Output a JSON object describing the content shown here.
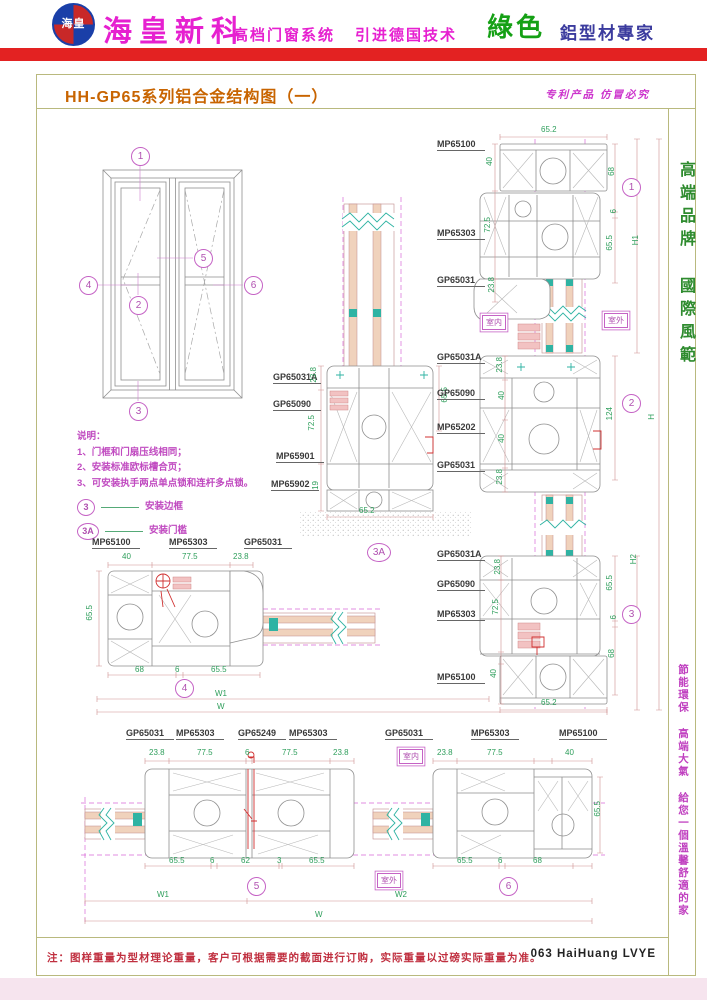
{
  "colors": {
    "brand_magenta": "#e620d0",
    "header_green": "#15a015",
    "header_blue": "#3b3b9e",
    "red_bar": "#e32222",
    "title_orange": "#c86400",
    "callout_magenta": "#c563c5",
    "dim_green": "#2e9e5b",
    "note_red": "#c03040",
    "frame_border": "#b9b97e"
  },
  "header": {
    "logo_text": "海皇",
    "brand": "海皇新科",
    "tagline1": "高档门窗系统",
    "tagline2": "引进德国技术",
    "green": "綠色",
    "expert": "鋁型材專家"
  },
  "titlebar": {
    "title": "HH-GP65系列铝合金结构图（一）",
    "patent": "专利产品 仿冒必究"
  },
  "sidebar": {
    "top": "高端品牌 國際風範",
    "bottom": "節能環保 高端大氣 給您一個溫馨舒適的家"
  },
  "footer": {
    "note": "注：图样重量为型材理论重量，客户可根据需要的截面进行订购，实际重量以过磅实际重量为准。",
    "page_code": "063 HaiHuang LVYE"
  },
  "notes": {
    "heading": "说明：",
    "lines": [
      "1、门框和门扇压线相同；",
      "2、安装标准欧标槽合页；",
      "3、可安装执手两点单点锁和连杆多点锁。"
    ],
    "legend": [
      {
        "num": "3",
        "text": "安装边框"
      },
      {
        "num": "3A",
        "text": "安装门槛"
      }
    ]
  },
  "room": {
    "inside": "室内",
    "outside": "室外"
  },
  "callouts": {
    "c1": "1",
    "c2": "2",
    "c3": "3",
    "c4": "4",
    "c5": "5",
    "c6": "6",
    "c3a": "3A"
  },
  "details": {
    "d1": {
      "profiles": [
        "MP65100",
        "MP65303",
        "GP65031"
      ],
      "dims": {
        "top": "65.2",
        "left": [
          "40",
          "72.5",
          "23.8"
        ],
        "right": [
          "68",
          "6",
          "65.5"
        ],
        "height": "H1"
      }
    },
    "d2": {
      "profiles": [
        "GP65031A",
        "GP65090",
        "MP65202",
        "GP65031"
      ],
      "dims": {
        "left": [
          "23.8",
          "40",
          "40",
          "23.8"
        ],
        "right": [
          "124"
        ],
        "height": "H"
      }
    },
    "d3": {
      "profiles": [
        "GP65031A",
        "GP65090",
        "MP65303",
        "MP65100"
      ],
      "dims": {
        "left": [
          "23.8",
          "72.5",
          "40"
        ],
        "right": [
          "65.5",
          "6",
          "68"
        ],
        "bottom": "65.2",
        "height": "H2"
      }
    },
    "d3a": {
      "profiles": [
        "GP65031A",
        "GP65090",
        "MP65901",
        "MP65902"
      ],
      "dims": {
        "left": [
          "23.8",
          "72.5",
          "19"
        ],
        "right": [
          "65.5"
        ],
        "bottom": "65.2"
      }
    },
    "d4": {
      "profiles": [
        "MP65100",
        "MP65303",
        "GP65031"
      ],
      "dims": {
        "top": [
          "40",
          "77.5",
          "23.8"
        ],
        "left": [
          "65.5"
        ],
        "bottom": [
          "68",
          "6",
          "65.5"
        ]
      }
    },
    "d5": {
      "profiles": [
        "GP65031",
        "MP65303",
        "GP65249",
        "MP65303"
      ],
      "dims": {
        "top": [
          "23.8",
          "77.5",
          "6",
          "77.5",
          "23.8"
        ],
        "bottom": [
          "65.5",
          "6",
          "62",
          "3",
          "65.5"
        ]
      }
    },
    "d6": {
      "profiles": [
        "GP65031",
        "MP65303",
        "MP65100"
      ],
      "dims": {
        "top": [
          "23.8",
          "77.5",
          "40"
        ],
        "right": [
          "65.5"
        ],
        "bottom": [
          "65.5",
          "6",
          "68"
        ]
      }
    }
  },
  "overall": {
    "w1": "W1",
    "w2": "W2",
    "w": "W"
  }
}
